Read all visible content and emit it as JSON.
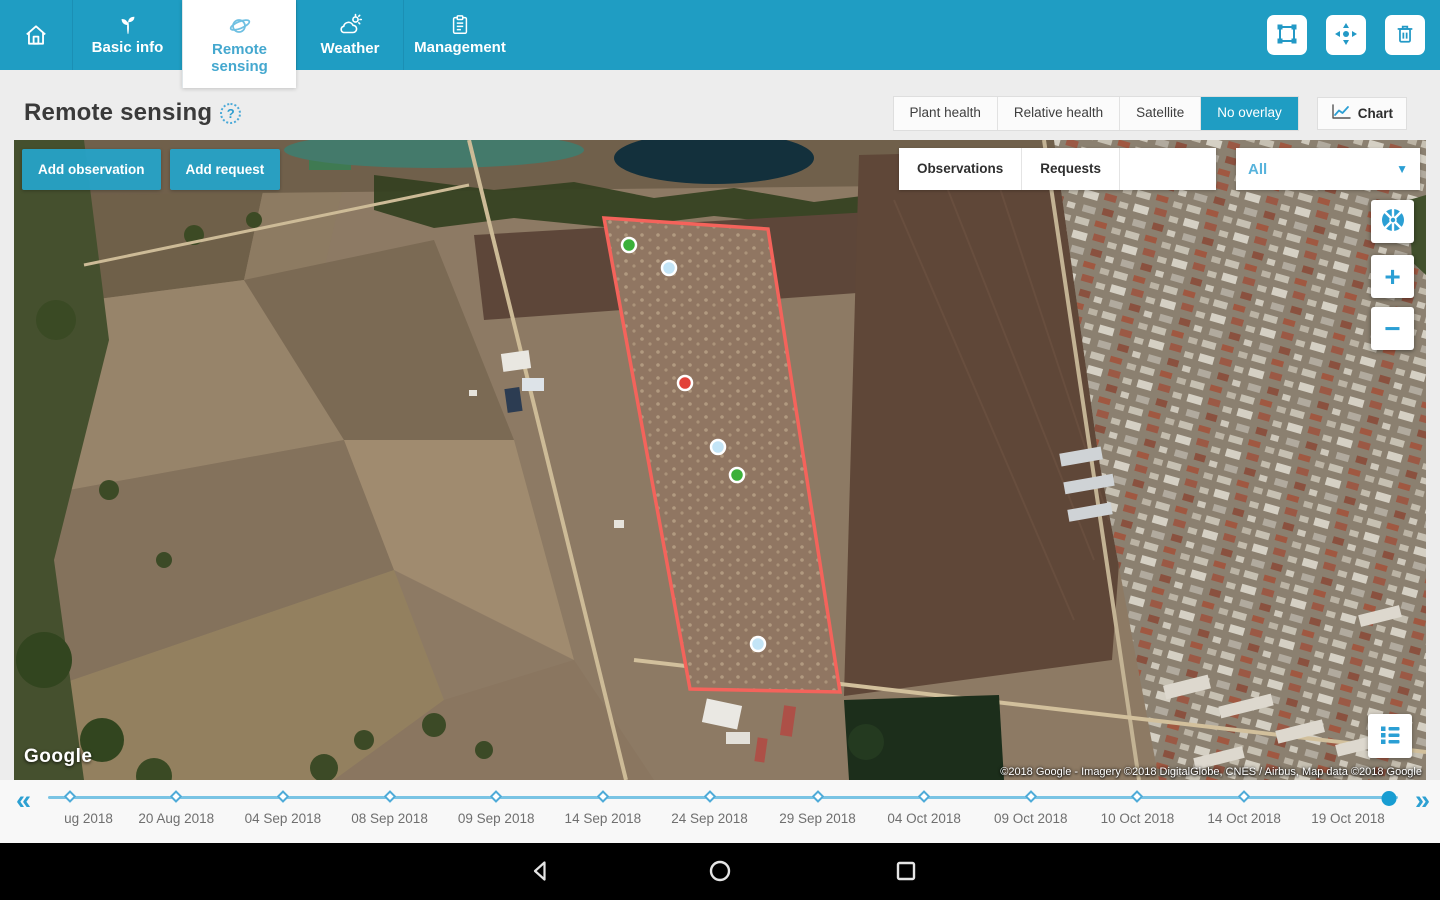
{
  "colors": {
    "primary_teal": "#1f9dc3",
    "icon_blue": "#2b9fd4",
    "polygon_red": "#f4635b",
    "timeline_track": "#7ac4e4",
    "selected_dot": "#189dd2"
  },
  "header": {
    "tabs": [
      {
        "id": "home",
        "label": "",
        "icon": "home-icon",
        "active": false
      },
      {
        "id": "basic-info",
        "label": "Basic info",
        "icon": "sprout-icon",
        "active": false
      },
      {
        "id": "remote-sensing",
        "label": "Remote sensing",
        "icon": "satellite-icon",
        "active": true
      },
      {
        "id": "weather",
        "label": "Weather",
        "icon": "weather-cloud-icon",
        "active": false
      },
      {
        "id": "management",
        "label": "Management",
        "icon": "clipboard-icon",
        "active": false
      }
    ],
    "actions": [
      {
        "icon": "edit-boundary-icon"
      },
      {
        "icon": "center-target-icon"
      },
      {
        "icon": "trash-icon"
      }
    ]
  },
  "page": {
    "title": "Remote sensing",
    "help_icon": "help-icon"
  },
  "view_controls": {
    "options": [
      {
        "label": "Plant health",
        "active": false
      },
      {
        "label": "Relative health",
        "active": false
      },
      {
        "label": "Satellite",
        "active": false
      },
      {
        "label": "No overlay",
        "active": true
      }
    ],
    "chart_label": "Chart",
    "chart_icon": "line-chart-icon"
  },
  "map": {
    "buttons": {
      "add_observation": "Add observation",
      "add_request": "Add request"
    },
    "filters": {
      "options": [
        {
          "label": "Observations",
          "active": false
        },
        {
          "label": "Requests",
          "active": false
        },
        {
          "label": "All",
          "active": true
        }
      ],
      "dropdown_value": "All",
      "dropdown_icon": "chevron-down-icon"
    },
    "controls": {
      "locate_icon": "locate-aperture-icon",
      "zoom_in": "+",
      "zoom_out": "−",
      "legend_icon": "legend-list-icon"
    },
    "logo": "Google",
    "attribution": "©2018 Google - Imagery ©2018 DigitalGlobe, CNES / Airbus, Map data ©2018 Google",
    "field_polygon": {
      "stroke": "#f4635b",
      "points": [
        [
          590,
          78
        ],
        [
          754,
          89
        ],
        [
          826,
          552
        ],
        [
          676,
          549
        ]
      ]
    },
    "markers": [
      {
        "x": 615,
        "y": 105,
        "color": "#3bb03a",
        "type": "observation-green"
      },
      {
        "x": 655,
        "y": 128,
        "color": "#c3e4f6",
        "type": "observation-blue"
      },
      {
        "x": 671,
        "y": 243,
        "color": "#e2423a",
        "type": "observation-red"
      },
      {
        "x": 704,
        "y": 307,
        "color": "#c3e4f6",
        "type": "observation-blue"
      },
      {
        "x": 723,
        "y": 335,
        "color": "#3bb03a",
        "type": "observation-green"
      },
      {
        "x": 744,
        "y": 504,
        "color": "#c3e4f6",
        "type": "observation-blue"
      }
    ]
  },
  "timeline": {
    "prev_icon": "«",
    "next_icon": "»",
    "points": [
      {
        "label": "ug 2018",
        "pos": 1.6,
        "label_pos": 3.0,
        "selected": false
      },
      {
        "label": "20 Aug 2018",
        "pos": 9.5,
        "label_pos": 9.5,
        "selected": false
      },
      {
        "label": "04 Sep 2018",
        "pos": 17.4,
        "label_pos": 17.4,
        "selected": false
      },
      {
        "label": "08 Sep 2018",
        "pos": 25.3,
        "label_pos": 25.3,
        "selected": false
      },
      {
        "label": "09 Sep 2018",
        "pos": 33.2,
        "label_pos": 33.2,
        "selected": false
      },
      {
        "label": "14 Sep 2018",
        "pos": 41.1,
        "label_pos": 41.1,
        "selected": false
      },
      {
        "label": "24 Sep 2018",
        "pos": 49.0,
        "label_pos": 49.0,
        "selected": false
      },
      {
        "label": "29 Sep 2018",
        "pos": 57.0,
        "label_pos": 57.0,
        "selected": false
      },
      {
        "label": "04 Oct 2018",
        "pos": 64.9,
        "label_pos": 64.9,
        "selected": false
      },
      {
        "label": "09 Oct 2018",
        "pos": 72.8,
        "label_pos": 72.8,
        "selected": false
      },
      {
        "label": "10 Oct 2018",
        "pos": 80.7,
        "label_pos": 80.7,
        "selected": false
      },
      {
        "label": "14 Oct 2018",
        "pos": 88.6,
        "label_pos": 88.6,
        "selected": false
      },
      {
        "label": "19 Oct 2018",
        "pos": 99.3,
        "label_pos": 96.3,
        "selected": true
      }
    ]
  },
  "android_nav": {
    "back": "back-icon",
    "home": "home-circle-icon",
    "recents": "recents-square-icon"
  }
}
